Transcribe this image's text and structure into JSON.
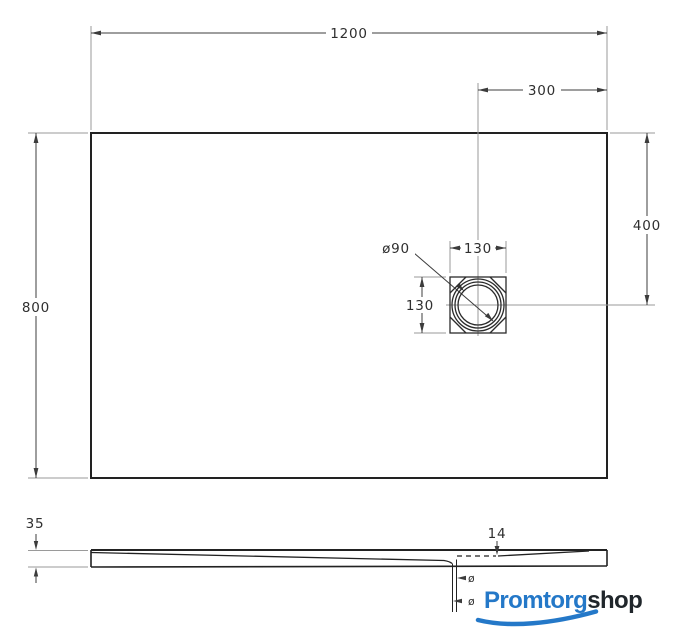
{
  "top_view": {
    "width_label": "1200",
    "height_label": "800",
    "drain_offset_right_label": "300",
    "drain_offset_top_label": "400",
    "drain_width_label": "130",
    "drain_height_label": "130",
    "drain_diameter_label": "ø90"
  },
  "side_view": {
    "height_label": "35",
    "depth_at_drain_label": "14",
    "outlet_label_1": "ø",
    "outlet_label_2": "ø"
  },
  "logo": {
    "text_primary": "Promtorg",
    "text_secondary": "shop",
    "color_primary": "#2478c8",
    "color_secondary": "#20262b"
  }
}
